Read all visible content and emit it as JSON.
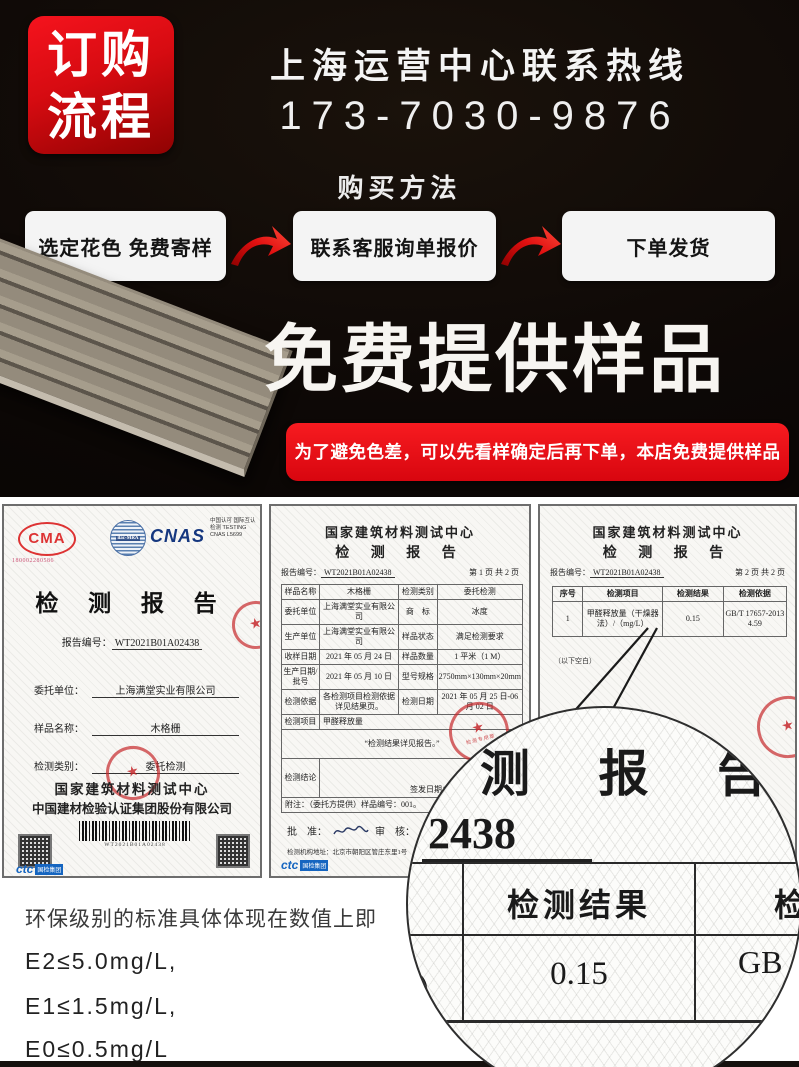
{
  "colors": {
    "accent_red": "#e60012",
    "dark_background": "#0d0806",
    "paper": "#f8f7f4",
    "cnas_blue": "#15377f",
    "ctc_blue": "#1565c0",
    "stamp_red": "#c62828"
  },
  "header": {
    "badge_line1": "订购",
    "badge_line2": "流程",
    "hotline_title": "上海运营中心联系热线",
    "phone": "173-7030-9876",
    "method_title": "购买方法",
    "steps": [
      "选定花色 免费寄样",
      "联系客服询单报价",
      "下单发货"
    ],
    "free_sample_title": "免费提供样品",
    "notice": "为了避免色差，可以先看样确定后再下单，本店免费提供样品哦！"
  },
  "certificates": {
    "cert1": {
      "cma_label": "CMA",
      "cma_number": "180002280586",
      "ilac_label": "ilac-MRA",
      "cnas_label": "CNAS",
      "cnas_caption": "中国认可 国际互认 检测 TESTING CNAS L5699",
      "title": "检 测 报 告",
      "report_no_label": "报告编号：",
      "report_no": "WT2021B01A02438",
      "fields": [
        {
          "label": "委托单位：",
          "value": "上海满堂实业有限公司"
        },
        {
          "label": "样品名称：",
          "value": "木格栅"
        },
        {
          "label": "检测类别：",
          "value": "委托检测"
        }
      ],
      "org_line1": "国家建筑材料测试中心",
      "org_line2": "中国建材检验认证集团股份有限公司",
      "barcode_number": "WT2021B01A02438",
      "stamp_text": "检测专用章",
      "ctc_mark": "ctc",
      "ctc_sub": "国检集团"
    },
    "cert2": {
      "center_name": "国家建筑材料测试中心",
      "title": "检 测 报 告",
      "report_no_label": "报告编号：",
      "report_no": "WT2021B01A02438",
      "page": "第 1 页 共 2 页",
      "rows": [
        [
          "样品名称",
          "木格栅",
          "检测类别",
          "委托检测"
        ],
        [
          "委托单位",
          "上海满堂实业有限公司",
          "商　标",
          "冰度"
        ],
        [
          "生产单位",
          "上海满堂实业有限公司",
          "样品状态",
          "满足检测要求"
        ],
        [
          "收样日期",
          "2021 年 05 月 24 日",
          "样品数量",
          "1 平米（1 M）"
        ],
        [
          "生产日期/批号",
          "2021 年 05 月 10 日",
          "型号规格",
          "2750mm×130mm×20mm"
        ],
        [
          "检测依据",
          "各检测项目检测依据详见结果页。",
          "检测日期",
          "2021 年 05 月 25 日-06 月 02 日"
        ]
      ],
      "item_label": "检测项目",
      "item_value": "甲醛释放量",
      "result_note": "“检测结果详见报告。”",
      "conclusion_label": "检测结论",
      "issue_date": "签发日期：2021 年 06 月 03 日",
      "footnote": "附注：（委托方提供）样品编号：001。",
      "approve_label": "批　准：",
      "review_label": "审　核：",
      "address": "检测机构地址：北京市朝阳区管庄东里1号",
      "stamp_text": "检测专用章",
      "ctc_mark": "ctc",
      "ctc_sub": "国检集团"
    },
    "cert3": {
      "center_name": "国家建筑材料测试中心",
      "title": "检 测 报 告",
      "report_no_label": "报告编号：",
      "report_no": "WT2021B01A02438",
      "page": "第 2 页 共 2 页",
      "headers": [
        "序号",
        "检测项目",
        "检测结果",
        "检测依据"
      ],
      "row": [
        "1",
        "甲醛释放量（干燥器法）/（mg/L）",
        "0.15",
        "GB/T 17657-2013 4.59"
      ],
      "blank_note": "（以下空白）",
      "stamp_text": "检测专用章"
    }
  },
  "magnifier": {
    "title_partial": "测 报 告",
    "number_partial": "2438",
    "result_header": "检测结果",
    "result_header_partial": "检",
    "result_value": "0.15",
    "basis_partial": "GB",
    "left_partial": "）"
  },
  "eco": {
    "intro": "环保级别的标准具体体现在数值上即",
    "lines": [
      "E2≤5.0mg/L,",
      "E1≤1.5mg/L,",
      "E0≤0.5mg/L"
    ]
  }
}
